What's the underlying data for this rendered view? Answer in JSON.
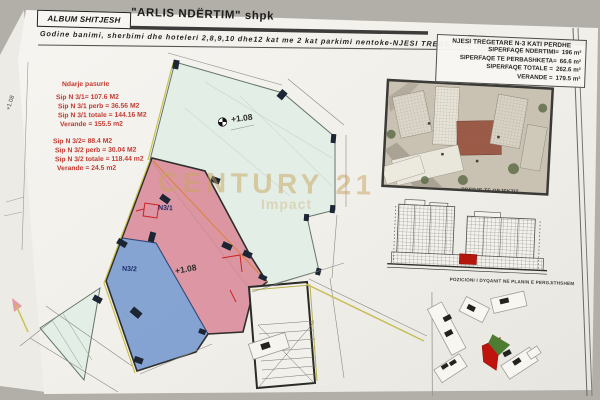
{
  "header": {
    "album_label": "ALBUM SHITJESH",
    "company": "\"ARLIS NDËRTIM\" shpk",
    "subtitle": "Godine banimi, sherbimi dhe hoteleri 2,8,9,10 dhe12 kat me 2 kat parkimi nentoke-NJESI TREGETARE SHKALLA 3"
  },
  "underlay": {
    "level_label": "+1.08"
  },
  "plan": {
    "annotation": {
      "title": "Ndarje pasurie",
      "unit1_lines": [
        "Sip N 3/1= 107.6 M2",
        "Sip N 3/1 perb = 36.56 M2",
        "Sip N 3/1 totale = 144.16 M2",
        "Verande = 155.5 m2"
      ],
      "unit2_lines": [
        "Sip N 3/2= 88.4 M2",
        "Sip N 3/2 perb = 30.04 M2",
        "Sip N 3/2 totale = 118.44 m2",
        "Verande = 24.5 m2"
      ]
    },
    "unit1_label": "N3/1",
    "unit2_label": "N3/2",
    "level_label_verande": "+1.08",
    "level_label_unit": "+1.08",
    "colors": {
      "unit1_fill": "#db8e9c",
      "unit2_fill": "#7d9ed0",
      "verande_fill": "#e3eee6",
      "annotation_text": "#c23a33",
      "division_line": "#d8833a",
      "highlight_red": "#b5170c",
      "highlight_green": "#4e7c33"
    }
  },
  "info_table": {
    "title": "NJESI TREGETARE N-3 KATI PERDHE",
    "rows": [
      {
        "label": "SIPERFAQE NDERTIMI=",
        "value": "196 m²"
      },
      {
        "label": "SIPERFAQE TE PERBASHKETA=",
        "value": "66.6 m²"
      },
      {
        "label": "SIPERFAQE TOTALE =",
        "value": "262.6 m²"
      },
      {
        "label": "VERANDE =",
        "value": "179.5 m²"
      }
    ]
  },
  "right_panel": {
    "render_caption": "PRERJE TE OBJEKTIT",
    "siteplan_caption": "POZICIONI I DYQANIT NE PLANIN E PERGJITHSHEM"
  },
  "watermark": {
    "text": "CENTURY 21",
    "subtext": "Impact",
    "color": "#c8a45f"
  }
}
